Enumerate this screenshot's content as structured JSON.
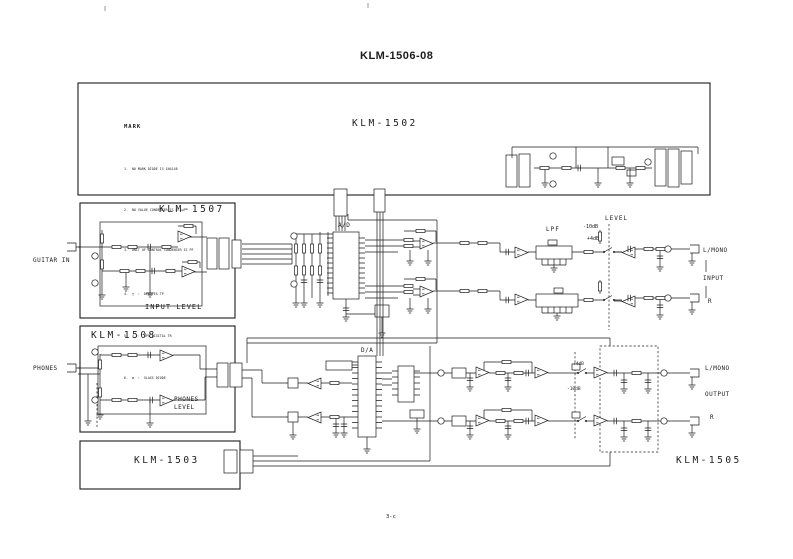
{
  "title": "KLM-1506-08",
  "page_number": "3-c",
  "boards": {
    "klm1502": "KLM-1502",
    "klm1507": "KLM-1507",
    "klm1508": "KLM-1508",
    "klm1503": "KLM-1503",
    "klm1505": "KLM-1505"
  },
  "sections": {
    "adc": "A/D",
    "dac": "D/A",
    "lpf": "LPF",
    "level": "LEVEL",
    "input_level": "INPUT LEVEL",
    "phones_level_line1": "PHONES",
    "phones_level_line2": "LEVEL"
  },
  "jacks": {
    "guitar_in": "GUITAR IN",
    "phones": "PHONES",
    "input_l": "L/MONO",
    "input_group": "INPUT",
    "input_r": "R",
    "output_l": "L/MONO",
    "output_group": "OUTPUT",
    "output_r": "R"
  },
  "level_settings": {
    "input_pad_1": "-10dB",
    "input_pad_2": "+4dB",
    "output_pad_1": "+4dB",
    "output_pad_2": "-10dB"
  },
  "mark_legend": {
    "heading": "MARK",
    "items": [
      "1.  NO MARK DIODE IS 1N4148",
      "2.  NO VALUE CONDENSER IS 0.1µF",
      "3.  UNIT OF CONTROL CONDENSER IS PF",
      "4.  □  :  DENOTES TP",
      "5.  ◇  :  SPS DIGITAL TR",
      "6.  ø  :  GLASS DIODE"
    ]
  },
  "colors": {
    "ink": "#1b1b1b",
    "paper": "#ffffff"
  }
}
